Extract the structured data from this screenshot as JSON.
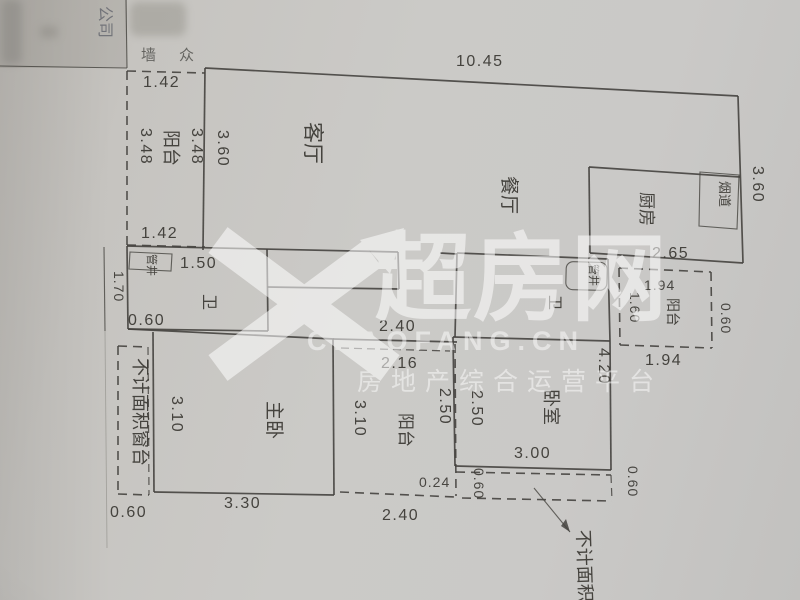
{
  "stamp": {
    "company_text": "公司",
    "char_a": "墙",
    "char_b": "众"
  },
  "watermark": {
    "brand": "超房网",
    "domain": "CHAOFANG.CN",
    "tagline": "房地产综合运营平台",
    "color": "#ffffff"
  },
  "plan": {
    "line_color": "#45433f",
    "rooms": [
      {
        "id": "living",
        "label": "客厅"
      },
      {
        "id": "dining",
        "label": "餐厅"
      },
      {
        "id": "kitchen",
        "label": "厨房"
      },
      {
        "id": "flue",
        "label": "烟道"
      },
      {
        "id": "balcony_left",
        "label": "阳台"
      },
      {
        "id": "balcony_right",
        "label": "阳台"
      },
      {
        "id": "balcony_bottom",
        "label": "阳台"
      },
      {
        "id": "bath_left",
        "label": "卫"
      },
      {
        "id": "bath_right",
        "label": "卫"
      },
      {
        "id": "shaft_left",
        "label": "管井"
      },
      {
        "id": "shaft_right",
        "label": "管井"
      },
      {
        "id": "bedroom",
        "label": "卧室"
      },
      {
        "id": "master_bedroom",
        "label": "主卧"
      }
    ],
    "notes": [
      {
        "id": "sill_left",
        "label": "不计面积窗台"
      },
      {
        "id": "sill_bottom",
        "label": "不计面积"
      }
    ],
    "dims": {
      "top_width": "10.45",
      "lb_top": "1.42",
      "lb_left": "3.48",
      "lb_right": "3.48",
      "lb_bottom": "1.42",
      "living_left": "3.60",
      "right_side": "3.60",
      "kitchen_bottom": "2.65",
      "rb_top": "1.94",
      "rb_left": "1.60",
      "rb_right": "0.60",
      "rb_bottom": "1.94",
      "bath1_top": "1.50",
      "bath1_bottom": "0.60",
      "bath1_left": "1.70",
      "hall": "2.40",
      "bb_inner_top": "2.16",
      "bb_left": "3.10",
      "bb_right": "2.50",
      "bb_bottom": "2.40",
      "gap": "0.24",
      "gap_depth": "0.60",
      "bed_left": "2.50",
      "bed_right": "4.20",
      "bed_bottom": "3.00",
      "bed_strip": "0.60",
      "master_left": "3.10",
      "master_bottom": "3.30",
      "sill_bottom_left": "0.60"
    }
  }
}
